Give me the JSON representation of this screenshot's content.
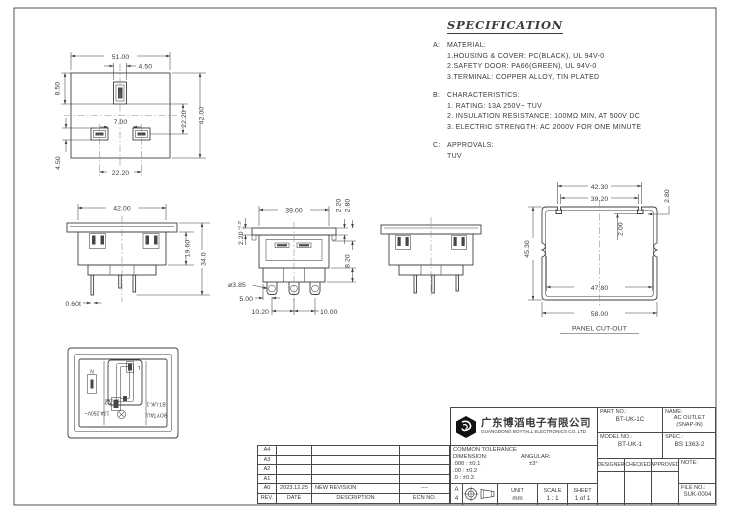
{
  "spec": {
    "title": "SPECIFICATION",
    "sections": [
      {
        "label": "A:",
        "heading": "MATERIAL:",
        "lines": [
          "1.HOUSING & COVER: PC(BLACK), UL 94V-0",
          "2.SAFETY DOOR: PA66(GREEN), UL 94V-0",
          "3.TERMINAL: COPPER ALLOY, TIN PLATED"
        ]
      },
      {
        "label": "B:",
        "heading": "CHARACTERISTICS:",
        "lines": [
          "1. RATING: 13A 250V~ TUV",
          "2. INSULATION RESISTANCE: 100MΩ MIN, AT 500V DC",
          "3. ELECTRIC STRENGTH: AC 2000V FOR ONE MINUTE"
        ]
      },
      {
        "label": "C:",
        "heading": "APPROVALS:",
        "lines": [
          "TUV"
        ]
      }
    ]
  },
  "views": {
    "top": {
      "dim_width_top": "51.00",
      "dim_slot_width": "4.50",
      "dim_slot_offset": "8.50",
      "dim_slot_to_center": "22.20",
      "dim_height": "42.00",
      "dim_hole_gap": "7.00",
      "dim_hole_span": "22.20",
      "dim_hole_height": "4.50"
    },
    "front": {
      "dim_width": "42.00",
      "dim_body_height": "19.60",
      "dim_total_height": "34.0",
      "dim_pin_thickness": "0.60t"
    },
    "bottom": {
      "dim_flange": "2.20",
      "dim_flange_tol_up": "+0.15",
      "dim_flange_tol_dn": "0",
      "dim_width": "39.00",
      "dim_lip_a": "2.20",
      "dim_lip_b": "2.80",
      "dim_depth": "8.20",
      "dim_hole_dia": "ø3.85",
      "dim_pin_offset": "5.00",
      "dim_pitch_left": "10.20",
      "dim_pitch_right": "10.00"
    },
    "cutout": {
      "caption": "PANEL CUT-OUT",
      "dim_notch_outer": "42.30",
      "dim_notch_inner": "39.20",
      "dim_notch_width": "2.80",
      "dim_notch_depth": "2.00",
      "dim_height": "45.30",
      "dim_inner_width": "47.80",
      "dim_width": "58.00"
    },
    "face": {
      "neutral": "N",
      "line": "L",
      "brand": "BOYTALL",
      "model": "BT-UK-1",
      "rating": "13A 250V~",
      "standard": "BS 1363"
    }
  },
  "title_block": {
    "company_cn": "广东博滔电子有限公司",
    "company_en": "GUANGDONG BOYTALL ELECTRONICS CO.,LTD",
    "part_no_label": "PART NO.:",
    "part_no": "BT-UK-1C",
    "name_label": "NAME:",
    "name_line1": "AC OUTLET",
    "name_line2": "(SNAP-IN)",
    "model_no_label": "MODEL NO.:",
    "model_no": "BT-UK-1",
    "spec_label": "SPEC.:",
    "spec_value": "BS 1363-2",
    "designer_label": "DESIGNER",
    "checked_label": "CHECKED",
    "approved_label": "APPROVED",
    "note_label": "NOTE:",
    "file_no_label": "FILE NO.:",
    "file_no": "SUK-0004",
    "tolerance_title": "COMMON TOLERANCE",
    "dimension_label": "DIMENSION:",
    "angular_label": "ANGULAR:",
    "angular_tol": "±3°",
    "tol_000": ".000 : ±0.1",
    "tol_00": ".00  : ±0.2",
    "tol_0": ".0   : ±0.3",
    "paper_a": "A",
    "paper_4": "4",
    "unit_label": "UNIT",
    "unit_value": "mm",
    "scale_label": "SCALE",
    "scale_value": "1 : 1",
    "sheet_label": "SHEET",
    "sheet_value": "1 of 1"
  },
  "revision_table": {
    "rows": [
      {
        "rev": "A4",
        "date": "",
        "description": "",
        "ecn": ""
      },
      {
        "rev": "A3",
        "date": "",
        "description": "",
        "ecn": ""
      },
      {
        "rev": "A2",
        "date": "",
        "description": "",
        "ecn": ""
      },
      {
        "rev": "A1",
        "date": "",
        "description": "",
        "ecn": ""
      },
      {
        "rev": "A0",
        "date": "2023.12.25",
        "description": "NEW REVISION",
        "ecn": "----"
      },
      {
        "rev": "REV.",
        "date": "DATE",
        "description": "DESCRIPTION",
        "ecn": "ECN NO."
      }
    ]
  }
}
